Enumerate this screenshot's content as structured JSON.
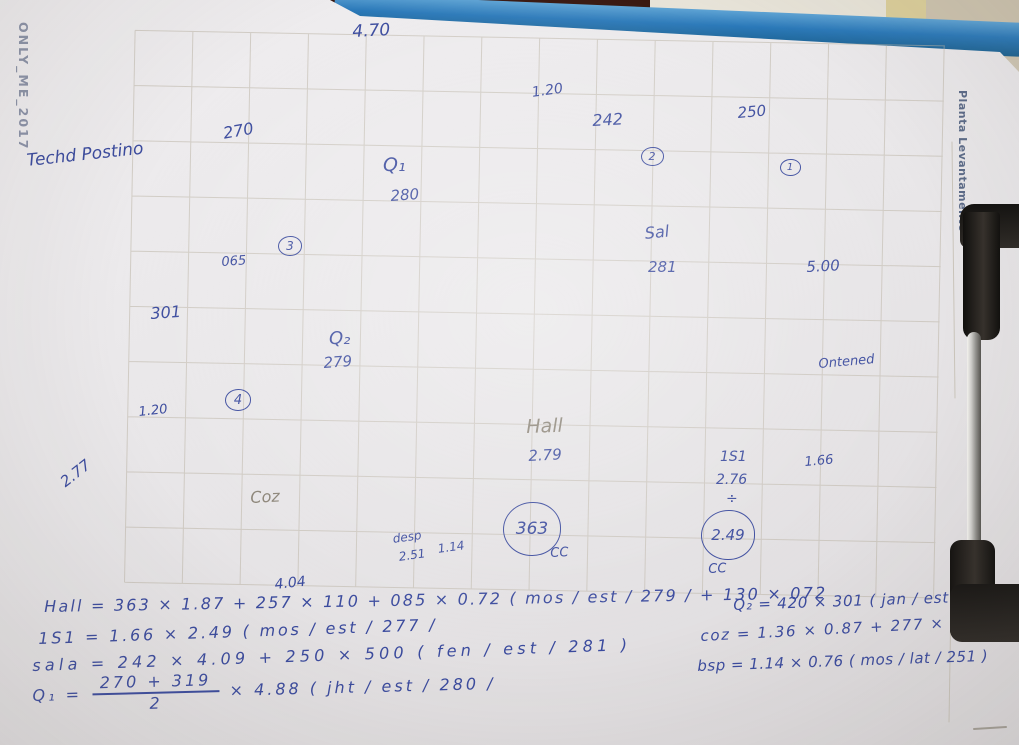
{
  "colors": {
    "ink": "#3b4b9e",
    "pencil": "#8a8376",
    "grid": "#bcb5a6",
    "paper": "#e9e7e9",
    "clip-blue": "#2b79b9",
    "wall-beige": "#cfc6b4",
    "wall-dark": "#381710",
    "stripe-yellow": "#dbce9a",
    "clip-black": "#1c1a18",
    "metal": "#b9b8b4"
  },
  "watermarks": {
    "left_vertical": "ONLY_ME_2017",
    "right_vertical": "Planta Levantamento"
  },
  "plan_labels": [
    {
      "id": "dim-470",
      "text": "4.70",
      "x": 352,
      "y": 24,
      "size": 17,
      "rot": -3
    },
    {
      "id": "dim-270",
      "text": "270",
      "x": 222,
      "y": 126,
      "size": 16,
      "rot": -10
    },
    {
      "id": "dim-120-top",
      "text": "1.20",
      "x": 531,
      "y": 86,
      "size": 14,
      "rot": -8
    },
    {
      "id": "dim-242",
      "text": "242",
      "x": 592,
      "y": 113,
      "size": 16,
      "rot": -3
    },
    {
      "id": "dim-250",
      "text": "250",
      "x": 737,
      "y": 106,
      "size": 15,
      "rot": -5
    },
    {
      "id": "room-q1",
      "text": "Q₁",
      "x": 383,
      "y": 156,
      "size": 19,
      "rot": 0
    },
    {
      "id": "dim-280",
      "text": "280",
      "x": 390,
      "y": 189,
      "size": 15,
      "rot": -4
    },
    {
      "id": "dim-065",
      "text": "065",
      "x": 221,
      "y": 256,
      "size": 13,
      "rot": -4
    },
    {
      "id": "dim-301",
      "text": "301",
      "x": 150,
      "y": 306,
      "size": 16,
      "rot": -4
    },
    {
      "id": "room-q2",
      "text": "Q₂",
      "x": 329,
      "y": 330,
      "size": 18,
      "rot": 0
    },
    {
      "id": "dim-279-q2",
      "text": "279",
      "x": 323,
      "y": 356,
      "size": 15,
      "rot": -4
    },
    {
      "id": "dim-120-left",
      "text": "1.20",
      "x": 138,
      "y": 406,
      "size": 13,
      "rot": -6
    },
    {
      "id": "room-sal",
      "text": "Sal",
      "x": 644,
      "y": 226,
      "size": 16,
      "rot": -6
    },
    {
      "id": "dim-281",
      "text": "281",
      "x": 648,
      "y": 260,
      "size": 15,
      "rot": 0
    },
    {
      "id": "dim-500",
      "text": "5.00",
      "x": 806,
      "y": 260,
      "size": 15,
      "rot": -3
    },
    {
      "id": "note-ontened",
      "text": "Ontened",
      "x": 818,
      "y": 358,
      "size": 13,
      "rot": -5
    },
    {
      "id": "room-hall",
      "text": "Hall",
      "x": 526,
      "y": 418,
      "size": 19,
      "rot": -2,
      "color": "pencil"
    },
    {
      "id": "dim-279-hall",
      "text": "2.79",
      "x": 528,
      "y": 449,
      "size": 15,
      "rot": -3
    },
    {
      "id": "room-1s1",
      "text": "1S1",
      "x": 720,
      "y": 450,
      "size": 14,
      "rot": 0
    },
    {
      "id": "dim-276",
      "text": "2.76",
      "x": 716,
      "y": 473,
      "size": 14,
      "rot": 0
    },
    {
      "id": "divide-mark",
      "text": "÷",
      "x": 726,
      "y": 492,
      "size": 14,
      "rot": 0
    },
    {
      "id": "dim-166",
      "text": "1.66",
      "x": 804,
      "y": 456,
      "size": 13,
      "rot": -5
    },
    {
      "id": "cc-left",
      "text": "CC",
      "x": 550,
      "y": 547,
      "size": 13,
      "rot": -3
    },
    {
      "id": "cc-right",
      "text": "CC",
      "x": 708,
      "y": 563,
      "size": 13,
      "rot": -3
    },
    {
      "id": "dim-277-left",
      "text": "2.77",
      "x": 58,
      "y": 478,
      "size": 15,
      "rot": -38
    },
    {
      "id": "room-coz",
      "text": "Coz",
      "x": 250,
      "y": 490,
      "size": 16,
      "rot": -3,
      "color": "pencil"
    },
    {
      "id": "room-desp",
      "text": "desp",
      "x": 392,
      "y": 533,
      "size": 12,
      "rot": -8
    },
    {
      "id": "dim-251",
      "text": "2.51",
      "x": 398,
      "y": 551,
      "size": 12,
      "rot": -8
    },
    {
      "id": "dim-114",
      "text": "1.14",
      "x": 437,
      "y": 543,
      "size": 12,
      "rot": -8
    },
    {
      "id": "dim-404",
      "text": "4.04",
      "x": 274,
      "y": 578,
      "size": 14,
      "rot": -6
    },
    {
      "id": "note-headline",
      "text": "Techd Postino",
      "x": 26,
      "y": 153,
      "size": 17,
      "rot": -6
    }
  ],
  "circled": [
    {
      "id": "ref-1",
      "text": "1",
      "x": 789,
      "y": 168,
      "d": 19,
      "size": 10
    },
    {
      "id": "ref-2",
      "text": "2",
      "x": 651,
      "y": 157,
      "d": 21,
      "size": 11
    },
    {
      "id": "ref-3",
      "text": "3",
      "x": 289,
      "y": 247,
      "d": 22,
      "size": 12
    },
    {
      "id": "ref-4",
      "text": "4",
      "x": 237,
      "y": 401,
      "d": 24,
      "size": 13
    },
    {
      "id": "val-363",
      "text": "363",
      "x": 531,
      "y": 530,
      "d": 56,
      "size": 17
    },
    {
      "id": "val-249",
      "text": "2.49",
      "x": 727,
      "y": 536,
      "d": 52,
      "size": 15
    }
  ],
  "formulas": {
    "left": [
      {
        "id": "hall",
        "text": "Hall = 363 × 1.87 + 257 × 110 + 085 × 0.72 ( mos / est / 279 / + 130 × 072",
        "x": 44,
        "y": 597,
        "size": 16,
        "ls": 2.2,
        "rot": -1
      },
      {
        "id": "1s1",
        "text": "1S1 = 1.66 × 2.49 ( mos / est / 277 /",
        "x": 38,
        "y": 629,
        "size": 16,
        "ls": 2.8,
        "rot": -2
      },
      {
        "id": "sala",
        "text": "sala = 242 × 4.09 + 250 × 500 ( fen / est / 281 )",
        "x": 32,
        "y": 656,
        "size": 16,
        "ls": 4.2,
        "rot": -2
      }
    ],
    "q1": {
      "lead": "Q₁ =",
      "num": "270 + 319",
      "den": "2",
      "tail": "× 4.88 ( jht / est / 280 /"
    },
    "right": [
      {
        "id": "q2",
        "text": "Q₂ = 420 × 301 ( jan / est / 279 )",
        "x": 733,
        "y": 596,
        "size": 15,
        "ls": 0.8,
        "rot": -2
      },
      {
        "id": "coz",
        "text": "coz = 1.36 × 0.87 + 277 × 4.04",
        "x": 700,
        "y": 627,
        "size": 15,
        "ls": 1.6,
        "rot": -3
      },
      {
        "id": "bsp",
        "text": "bsp = 1.14 × 0.76 ( mos / lat / 251 )",
        "x": 697,
        "y": 657,
        "size": 15,
        "ls": 0.5,
        "rot": -2
      }
    ]
  }
}
